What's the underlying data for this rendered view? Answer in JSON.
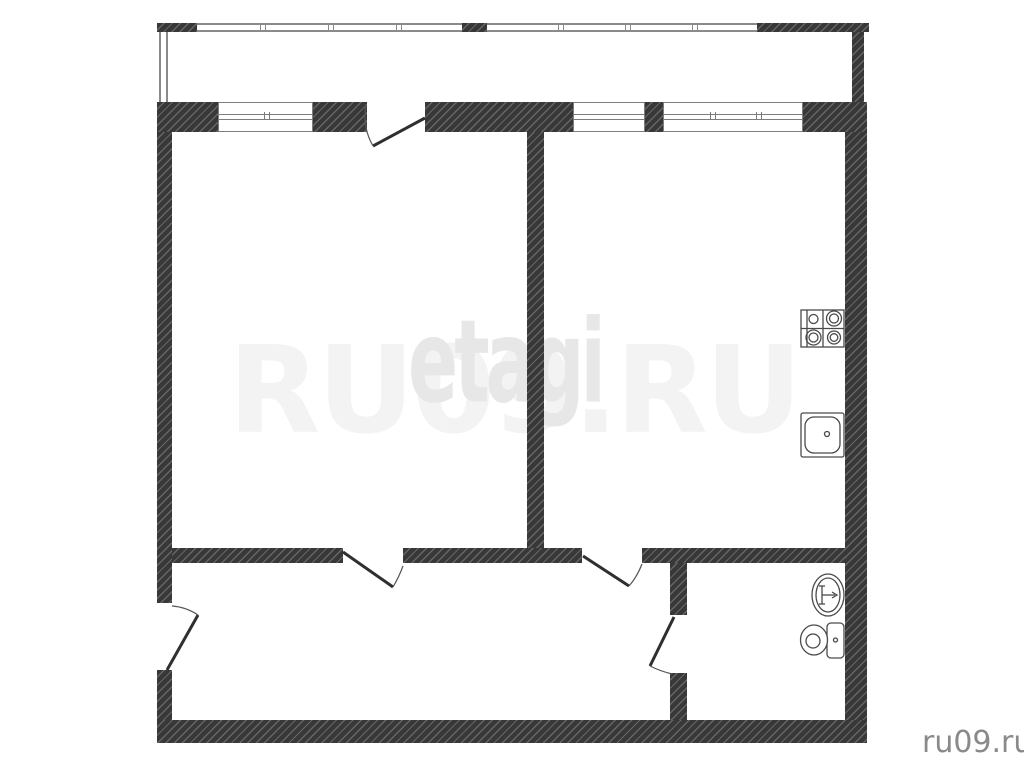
{
  "watermarks": {
    "center_site": "RU09.RU",
    "center_overlay": "etagi",
    "corner_site": "ru09.ru"
  },
  "colors": {
    "background": "#ffffff",
    "wall_fill": "#383838",
    "wall_hatch": "#666666",
    "thin_line": "#7d7d7d",
    "fixture_line": "#4a4a4a",
    "watermark_site": "#f3f3f3",
    "watermark_overlay": "#e7e7e7",
    "corner_text": "#8a8a8a"
  },
  "plan": {
    "type": "apartment-floor-plan",
    "areas": [
      "balcony",
      "room-left",
      "kitchen-room-right",
      "hallway",
      "bathroom"
    ],
    "windows": [
      "balcony-glazing-left",
      "balcony-glazing-right",
      "window-room-left",
      "window-kitchen-small",
      "window-kitchen-large"
    ],
    "doors": [
      "balcony-door",
      "room-left-door",
      "kitchen-door",
      "bathroom-door",
      "entrance-door"
    ],
    "fixtures": [
      "stove-icon",
      "kitchen-sink-icon",
      "wash-basin-icon",
      "toilet-icon"
    ]
  }
}
